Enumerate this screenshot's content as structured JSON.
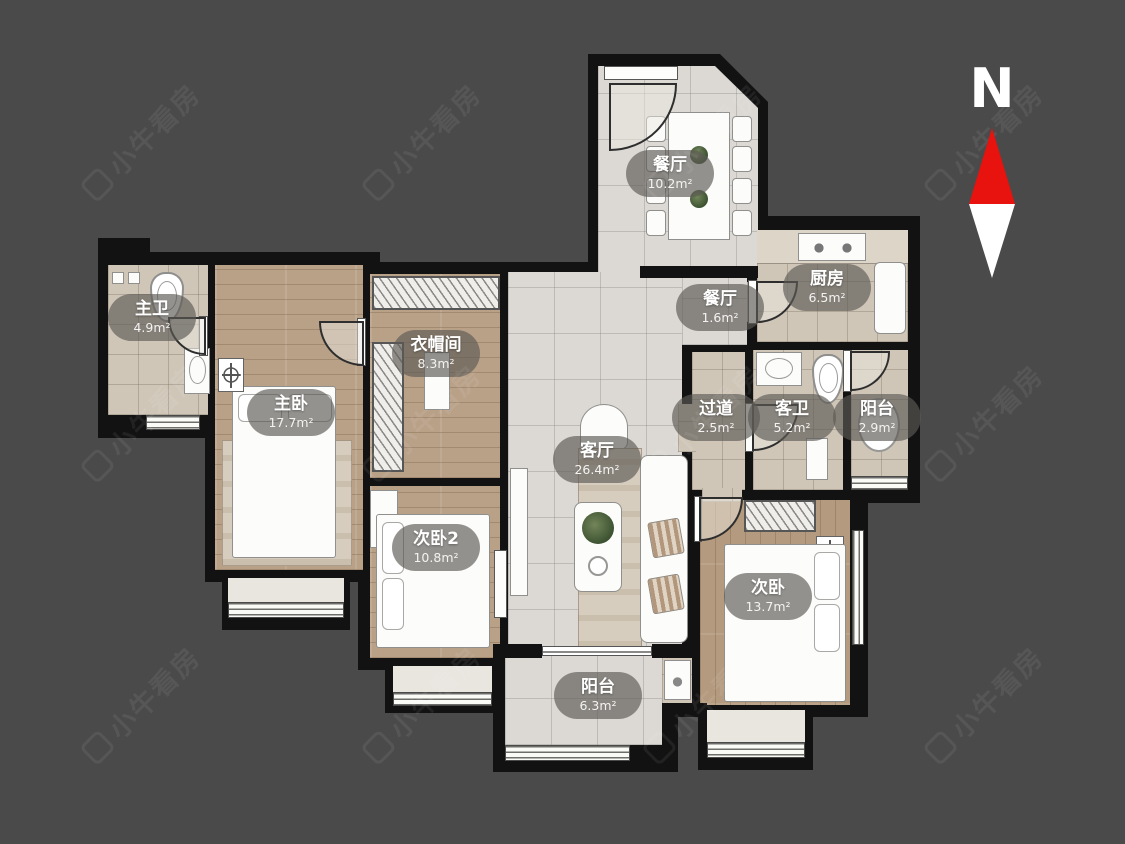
{
  "title": "户型图",
  "watermark": {
    "text": "小牛看房"
  },
  "compass": {
    "label": "N",
    "north_color": "#e8120e",
    "south_color": "#ffffff"
  },
  "colors": {
    "background": "#4a4a4a",
    "wall": "#121212",
    "tile_light": "#dcd9d4",
    "tile_beige": "#cfc6b8",
    "wood": "#b9a188",
    "label_bg": "rgba(92,89,85,0.66)",
    "label_text": "#ffffff"
  },
  "rooms": [
    {
      "id": "dining",
      "name": "餐厅",
      "area": "10.2m²"
    },
    {
      "id": "dining-nook",
      "name": "餐厅",
      "area": "1.6m²"
    },
    {
      "id": "kitchen",
      "name": "厨房",
      "area": "6.5m²"
    },
    {
      "id": "master-bath",
      "name": "主卫",
      "area": "4.9m²"
    },
    {
      "id": "master-bedroom",
      "name": "主卧",
      "area": "17.7m²"
    },
    {
      "id": "cloakroom",
      "name": "衣帽间",
      "area": "8.3m²"
    },
    {
      "id": "living-room",
      "name": "客厅",
      "area": "26.4m²"
    },
    {
      "id": "hallway",
      "name": "过道",
      "area": "2.5m²"
    },
    {
      "id": "guest-bath",
      "name": "客卫",
      "area": "5.2m²"
    },
    {
      "id": "balcony-east",
      "name": "阳台",
      "area": "2.9m²"
    },
    {
      "id": "bedroom-2",
      "name": "次卧2",
      "area": "10.8m²"
    },
    {
      "id": "bedroom",
      "name": "次卧",
      "area": "13.7m²"
    },
    {
      "id": "balcony-south",
      "name": "阳台",
      "area": "6.3m²"
    }
  ]
}
